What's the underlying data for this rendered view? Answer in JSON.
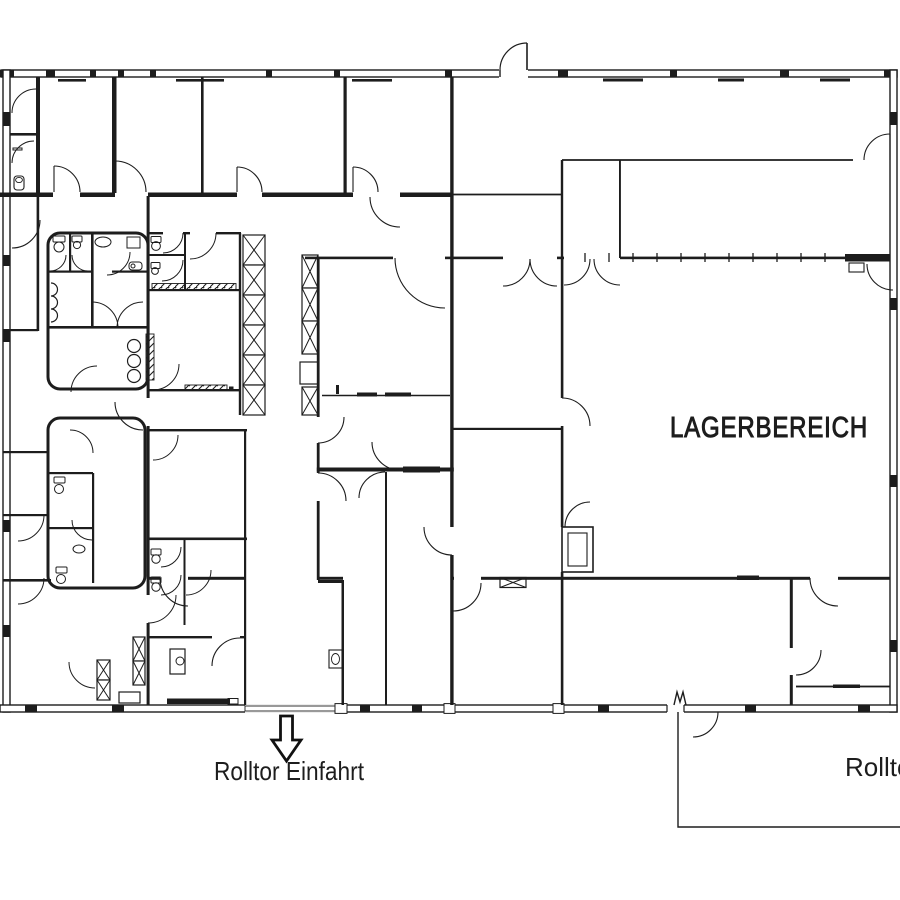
{
  "plan": {
    "type": "architectural-floor-plan",
    "warehouse_label": "LAGERBEREICH",
    "entrance_label": "Rolltor Einfahrt",
    "right_label": "Rolltor",
    "colors": {
      "ink": "#1d1d1d",
      "background": "#ffffff"
    },
    "features": {
      "warehouse_area": "large open hall right side",
      "entrance": "roller door at bottom center marked with down arrow",
      "second_roller_door": "bottom right, label clipped at image edge"
    }
  }
}
